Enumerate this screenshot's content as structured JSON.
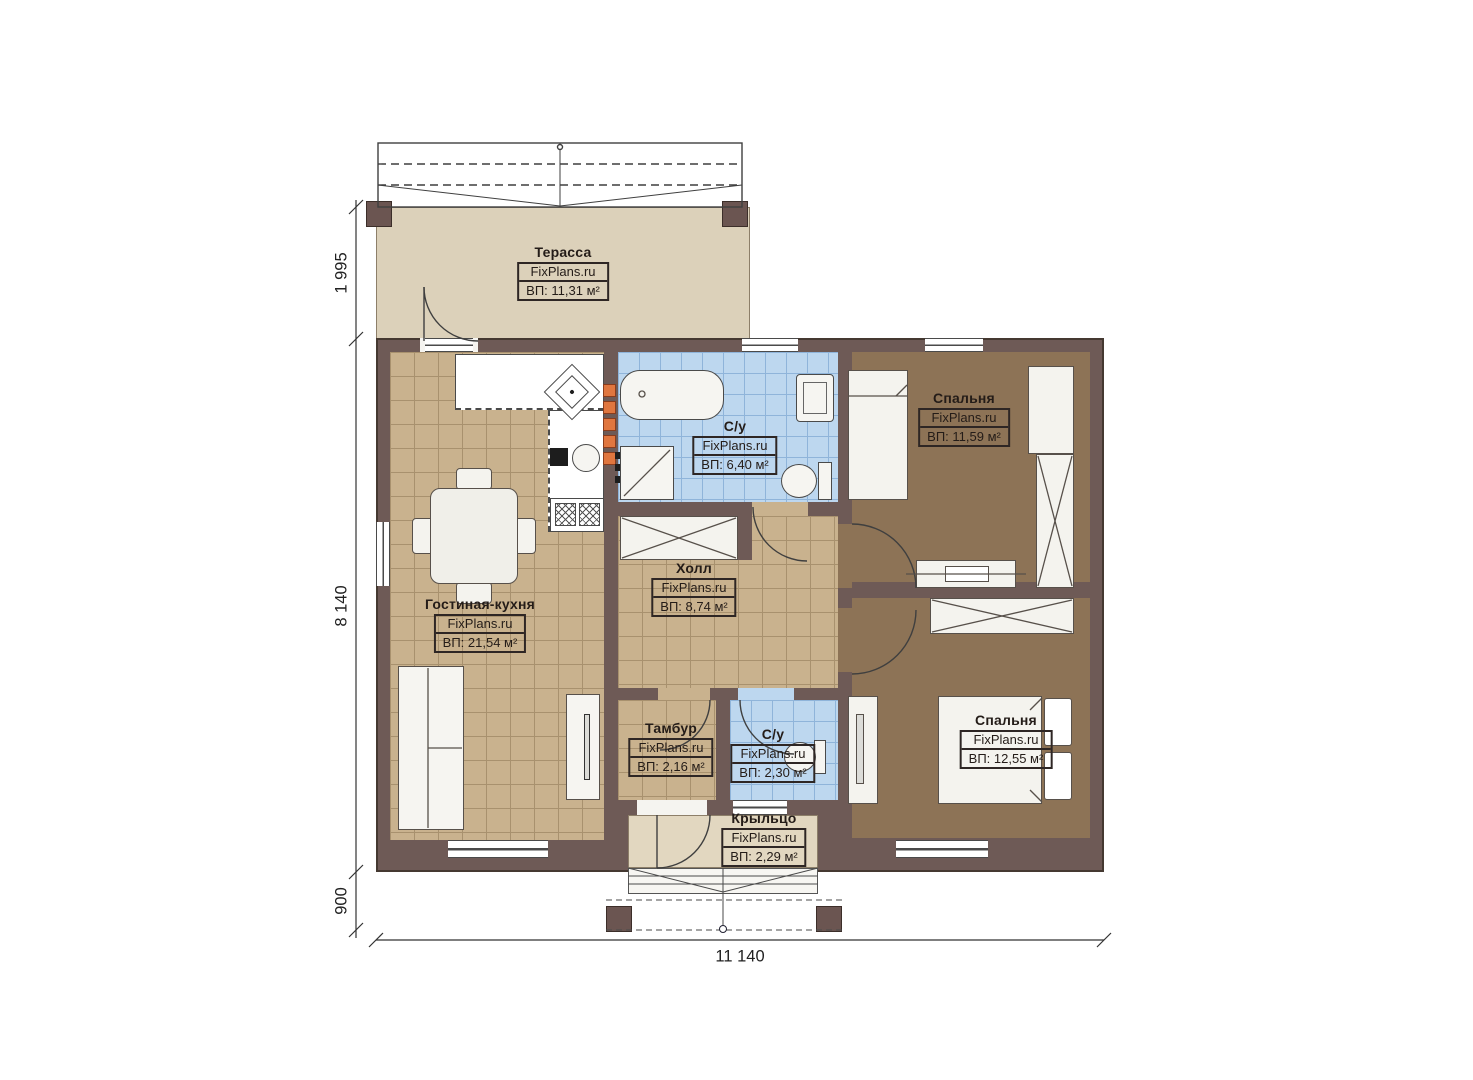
{
  "brand": "FixPlans.ru",
  "rooms": {
    "terrace": {
      "name": "Терасса",
      "area": "ВП: 11,31 м²"
    },
    "bathroom_main": {
      "name": "С/у",
      "area": "ВП: 6,40 м²"
    },
    "bedroom_top": {
      "name": "Спальня",
      "area": "ВП: 11,59 м²"
    },
    "living_kitchen": {
      "name": "Гостиная-кухня",
      "area": "ВП: 21,54 м²"
    },
    "hall": {
      "name": "Холл",
      "area": "ВП: 8,74 м²"
    },
    "tambour": {
      "name": "Тамбур",
      "area": "ВП: 2,16 м²"
    },
    "bathroom_small": {
      "name": "С/у",
      "area": "ВП: 2,30 м²"
    },
    "bedroom_bottom": {
      "name": "Спальня",
      "area": "ВП: 12,55 м²"
    },
    "porch": {
      "name": "Крыльцо",
      "area": "ВП: 2,29 м²"
    }
  },
  "dimensions": {
    "terrace_depth": "1 995",
    "house_depth": "8 140",
    "porch_depth": "900",
    "house_width": "11 140"
  },
  "colors": {
    "wall": "#6e5a56",
    "tile_tan": "#c9b28e",
    "tile_blue": "#bdd7ef",
    "floor_brown": "#8d7356",
    "terrace_floor": "#dcd1ba",
    "accent_orange": "#e0763f"
  }
}
